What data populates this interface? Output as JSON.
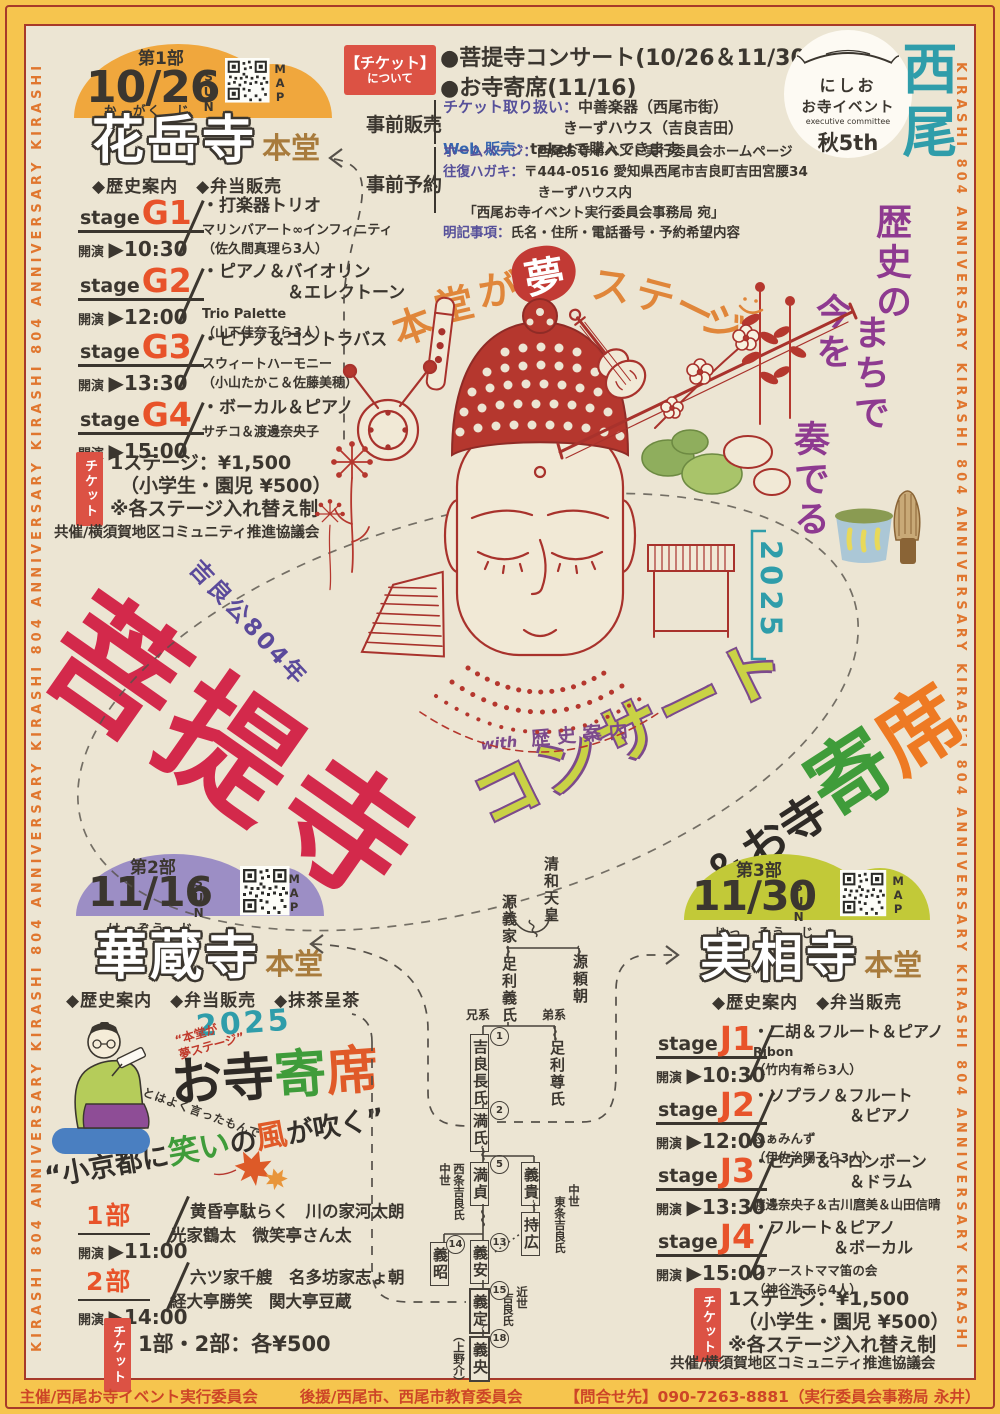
{
  "edges": {
    "text": "KIRASHI 804 ANNIVERSARY  KIRASHI 804 ANNIVERSARY  KIRASHI 804 ANNIVERSARY  KIRASHI 804 ANNIVERSARY  KIRASHI 804"
  },
  "brand": {
    "logo_top": "にしお",
    "logo_mid": "お寺イベント",
    "logo_sub": "executive committee",
    "logo_bottom": "秋5th",
    "v1": "西尾",
    "v2": "歴史の",
    "v3": "まちで",
    "v4": "今を",
    "v5": "奏でる"
  },
  "tagline": {
    "c1": "本",
    "c2": "堂",
    "c3": "が",
    "emph": "夢",
    "c4": "ス",
    "c5": "テ",
    "c6": "ー",
    "c7": "ジ"
  },
  "title": {
    "over": "吉良公804年",
    "main": "菩提寺",
    "concert": "コンサート",
    "amp": "＆お寺",
    "yose1": "寄",
    "yose2": "席",
    "year": "2025",
    "with_word": "with",
    "with_text": "歴史案内"
  },
  "ticket_info": {
    "box_l1": "【チケット】",
    "box_l2": "について",
    "b1": "●菩提寺コンサート(10/26＆11/30)",
    "b2": "●お寺寄席(11/16)",
    "presale": "事前販売",
    "p1_label": "チケット取り扱い：",
    "p1_value": "中善楽器（西尾市街）",
    "p2_value": "　　　　　　　　きーずハウス（吉良吉田）",
    "p3_label": "Web 販売：",
    "p3_value": "teketで購入できます",
    "reserve": "事前予約",
    "r1_label": "ホームページ：",
    "r1_value": "西尾お寺イベント実行委員会ホームページ",
    "r2_label": "往復ハガキ：",
    "r2_value": "〒444-0516 愛知県西尾市吉良町吉田宮腰34",
    "r3": "　　　　　　　きーずハウス内",
    "r4": "　　「西尾お寺イベント実行委員会事務局 宛」",
    "r5_label": "明記事項：",
    "r5_value": "氏名・住所・電話番号・予約希望内容"
  },
  "part1": {
    "part": "第1部",
    "date": "10/26",
    "day": "SUN",
    "map": "MAP",
    "furigana": "か　がく　じ",
    "temple": "花岳寺",
    "hall": "本堂",
    "features": "◆歴史案内　◆弁当販売",
    "stage_word": "stage",
    "time_word": "開演",
    "stages": [
      {
        "code": "G1",
        "time": "▶10:30",
        "program": "・打楽器トリオ",
        "group": "マリンバアート∞インフィニティ",
        "members": "（佐久間真理ら3人）"
      },
      {
        "code": "G2",
        "time": "▶12:00",
        "program": "・ピアノ＆バイオリン\n　　　　　＆エレクトーン",
        "group": "Trio Palette",
        "members": "（山下佳奈子ら3人）"
      },
      {
        "code": "G3",
        "time": "▶13:30",
        "program": "・ピアノ＆コントラバス",
        "group": "スウィートハーモニー",
        "members": "（小山たかこ＆佐藤美穂）"
      },
      {
        "code": "G4",
        "time": "▶15:00",
        "program": "・ボーカル＆ピアノ",
        "group": "サチコ＆渡邊奈央子",
        "members": ""
      }
    ],
    "ticket_tab": "チケット",
    "price1": "1ステージ：¥1,500",
    "price2": "（小学生・園児 ¥500）",
    "price3": "※各ステージ入れ替え制",
    "cohost": "共催/横須賀地区コミュニティ推進協議会"
  },
  "part2": {
    "part": "第2部",
    "date": "11/16",
    "day": "SUN",
    "map": "MAP",
    "furigana": "け　ぞう　じ",
    "temple": "華蔵寺",
    "hall": "本堂",
    "features": "◆歴史案内　◆弁当販売　◆抹茶呈茶",
    "yose_year": "2025",
    "yose_black": "お寺",
    "yose_green": "寄",
    "yose_orange": "席",
    "note1": "“本堂が",
    "note2": "夢ステージ”",
    "hand": "とはよく言ったもんで",
    "catch1": "“小京都に",
    "catch2": "笑い",
    "catch3": "の",
    "catch4": "風",
    "catch5": "が吹く”",
    "time_word": "開演",
    "shows": [
      {
        "code": "1部",
        "time": "▶11:00",
        "line1": "黄昏亭駄らく　川の家河太朗",
        "line2": "光家鶴太　微笑亭さん太"
      },
      {
        "code": "2部",
        "time": "▶14:00",
        "line1": "六ツ家千艘　名多坊家志ょ朝",
        "line2": "経大亭勝笑　関大亭豆蔵"
      }
    ],
    "ticket_tab": "チケット",
    "price": "1部・2部：各¥500"
  },
  "part3": {
    "part": "第3部",
    "date": "11/30",
    "day": "SUN",
    "map": "MAP",
    "furigana": "じっ　そう　じ",
    "temple": "実相寺",
    "hall": "本堂",
    "features": "◆歴史案内　◆弁当販売",
    "stage_word": "stage",
    "time_word": "開演",
    "stages": [
      {
        "code": "J1",
        "time": "▶10:30",
        "program": "・二胡＆フルート＆ピアノ",
        "group": "Ribon",
        "members": "（竹内有希ら3人）"
      },
      {
        "code": "J2",
        "time": "▶12:00",
        "program": "・ソプラノ＆フルート\n　　　　　　＆ピアノ",
        "group": "ふぁみんず",
        "members": "（伊佐治陽子ら3人）"
      },
      {
        "code": "J3",
        "time": "▶13:30",
        "program": "・ピアノ＆トロンボーン\n　　　　　　＆ドラム",
        "group": "渡邊奈央子＆古川麿美＆山田信晴",
        "members": ""
      },
      {
        "code": "J4",
        "time": "▶15:00",
        "program": "・フルート＆ピアノ\n　　　　　＆ボーカル",
        "group": "ファーストママ笛の会",
        "members": "（神谷浩子ら4人）"
      }
    ],
    "ticket_tab": "チケット",
    "price1": "1ステージ：¥1,500",
    "price2": "（小学生・園児 ¥500）",
    "price3": "※各ステージ入れ替え制",
    "cohost": "共催/横須賀地区コミュニティ推進協議会"
  },
  "tree": {
    "seiwa": "清和天皇",
    "yoshiie": "源義家",
    "yoritomo": "源頼朝",
    "yoshiuji": "足利義氏",
    "elder": "兄系",
    "younger": "弟系",
    "osauji": "吉良長氏",
    "takauji": "足利尊氏",
    "mitsuuji": "満氏",
    "mitsusada": "満貞",
    "yoshitaka": "義貴",
    "mochihiro": "持広",
    "yoshiyasu": "義安",
    "yoshiaki": "義昭",
    "yoshisada": "義定",
    "yoshihisa": "義央",
    "label_west1": "中世",
    "label_west2": "西条吉良氏",
    "label_east1": "中世",
    "label_east2": "東条吉良氏",
    "label_kinsei1": "近世",
    "label_kinsei2": "吉良氏",
    "kozuke": "（上野介）",
    "n1": "1",
    "n2": "2",
    "n5": "5",
    "n13": "13",
    "n14": "14",
    "n15": "15",
    "n18": "18"
  },
  "footer": {
    "host": "主催/西尾お寺イベント実行委員会",
    "support": "後援/西尾市、西尾市教育委員会",
    "contact": "【問合せ先】090-7263-8881（実行委員会事務局 永井）"
  }
}
